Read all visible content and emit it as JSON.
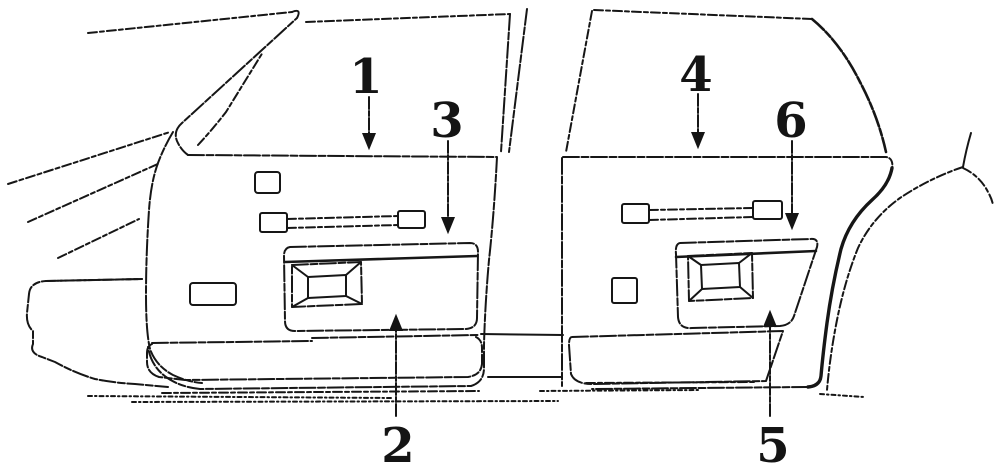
{
  "diagram": {
    "callouts": [
      {
        "label": "1"
      },
      {
        "label": "2"
      },
      {
        "label": "3"
      },
      {
        "label": "4"
      },
      {
        "label": "5"
      },
      {
        "label": "6"
      }
    ],
    "colors": {
      "ink": "#161616",
      "background": "#ffffff"
    }
  }
}
